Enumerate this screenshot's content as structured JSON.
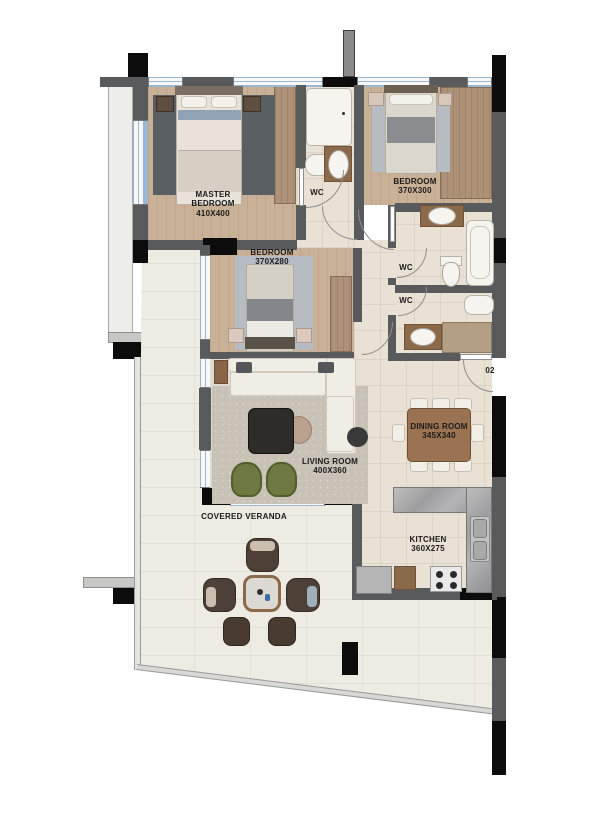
{
  "unit": {
    "number": "02"
  },
  "rooms": {
    "master_bedroom": {
      "name": "MASTER BEDROOM",
      "dims": "410X400"
    },
    "bedroom_2": {
      "name": "BEDROOM",
      "dims": "370X300"
    },
    "bedroom_3": {
      "name": "BEDROOM",
      "dims": "370X280"
    },
    "wc_top": {
      "name": "WC"
    },
    "wc_1": {
      "name": "WC"
    },
    "wc_2": {
      "name": "WC"
    },
    "living_room": {
      "name": "LIVING ROOM",
      "dims": "400X360"
    },
    "dining_room": {
      "name": "DINING ROOM",
      "dims": "345X340"
    },
    "kitchen": {
      "name": "KITCHEN",
      "dims": "360X275"
    },
    "veranda": {
      "name": "COVERED VERANDA"
    }
  },
  "palette": {
    "wall": "#595a5c",
    "column": "#0c0c0c",
    "window_blue": "#9bb6d1",
    "window_white": "#f8f8f8",
    "wood_floor": "#c8b197",
    "wood_dark": "#ad9277",
    "tile": "#e9e1d4",
    "living_floor": "#dfdbd2",
    "rug_living": "#c8c1b5",
    "rug_bedroom": "#b7bcc2",
    "rug_master": "#5a5f64",
    "veranda_floor": "#edebe2",
    "marble": "#a9a9ab",
    "fixture_white": "#f6f4ef",
    "counter_wood": "#8a6a4a",
    "table_wood": "#9b7352",
    "chair_white": "#f2efe7",
    "sofa_white": "#f0ede5",
    "green_chair": "#6e7942",
    "ledge": "#ededea",
    "label": "#1b1b1b"
  }
}
